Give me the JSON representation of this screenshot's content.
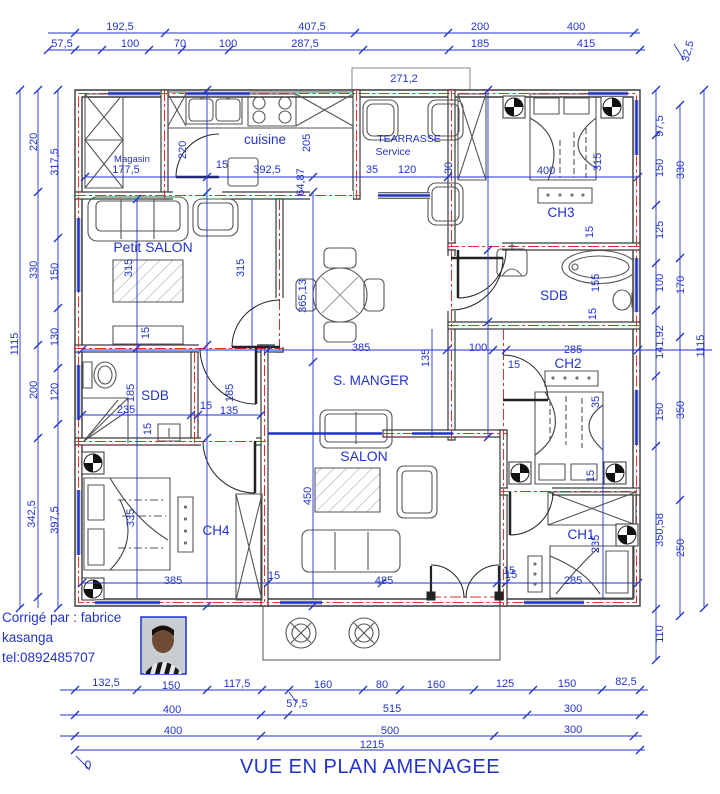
{
  "title": "VUE EN PLAN AMENAGEE",
  "credit": {
    "line1": "Corrigé par : fabrice",
    "line2": "kasanga",
    "line3": "tel:0892485707"
  },
  "colors": {
    "dimension_blue": "#2233cc",
    "wall_dark": "#3a3a3a",
    "axis_red": "#e03028",
    "background": "#ffffff"
  },
  "labels": [
    {
      "t": "192,5",
      "x": 120,
      "y": 30
    },
    {
      "t": "407,5",
      "x": 312,
      "y": 30
    },
    {
      "t": "200",
      "x": 480,
      "y": 30
    },
    {
      "t": "400",
      "x": 576,
      "y": 30
    },
    {
      "t": "57,5",
      "x": 62,
      "y": 47
    },
    {
      "t": "100",
      "x": 130,
      "y": 47
    },
    {
      "t": "70",
      "x": 180,
      "y": 47
    },
    {
      "t": "100",
      "x": 228,
      "y": 47
    },
    {
      "t": "287,5",
      "x": 305,
      "y": 47
    },
    {
      "t": "185",
      "x": 480,
      "y": 47
    },
    {
      "t": "415",
      "x": 586,
      "y": 47
    },
    {
      "t": "271,2",
      "x": 404,
      "y": 82
    },
    {
      "t": "32,5",
      "x": 691,
      "y": 52,
      "r": -75
    },
    {
      "t": "1115",
      "x": 18,
      "y": 344,
      "r": -90
    },
    {
      "t": "220",
      "x": 37,
      "y": 142,
      "r": -90
    },
    {
      "t": "317,5",
      "x": 58,
      "y": 162,
      "r": -90
    },
    {
      "t": "330",
      "x": 37,
      "y": 270,
      "r": -90
    },
    {
      "t": "150",
      "x": 58,
      "y": 272,
      "r": -90
    },
    {
      "t": "130",
      "x": 58,
      "y": 337,
      "r": -90
    },
    {
      "t": "200",
      "x": 37,
      "y": 390,
      "r": -90
    },
    {
      "t": "120",
      "x": 58,
      "y": 392,
      "r": -90
    },
    {
      "t": "342,5",
      "x": 35,
      "y": 514,
      "r": -90
    },
    {
      "t": "397,5",
      "x": 58,
      "y": 520,
      "r": -90
    },
    {
      "t": "97,5",
      "x": 663,
      "y": 126,
      "r": -90
    },
    {
      "t": "150",
      "x": 663,
      "y": 168,
      "r": -90
    },
    {
      "t": "330",
      "x": 684,
      "y": 170,
      "r": -90
    },
    {
      "t": "125",
      "x": 663,
      "y": 230,
      "r": -90
    },
    {
      "t": "100",
      "x": 663,
      "y": 283,
      "r": -90
    },
    {
      "t": "170",
      "x": 684,
      "y": 285,
      "r": -90
    },
    {
      "t": "141,92",
      "x": 663,
      "y": 342,
      "r": -90
    },
    {
      "t": "1115",
      "x": 704,
      "y": 346,
      "r": -90
    },
    {
      "t": "150",
      "x": 663,
      "y": 412,
      "r": -90
    },
    {
      "t": "350",
      "x": 684,
      "y": 410,
      "r": -90
    },
    {
      "t": "350,58",
      "x": 663,
      "y": 530,
      "r": -90
    },
    {
      "t": "250",
      "x": 684,
      "y": 548,
      "r": -90
    },
    {
      "t": "110",
      "x": 663,
      "y": 634,
      "r": -90
    },
    {
      "t": "132,5",
      "x": 106,
      "y": 686
    },
    {
      "t": "150",
      "x": 171,
      "y": 689
    },
    {
      "t": "117,5",
      "x": 237,
      "y": 687
    },
    {
      "t": "57,5",
      "x": 297,
      "y": 707
    },
    {
      "t": "160",
      "x": 323,
      "y": 688
    },
    {
      "t": "80",
      "x": 382,
      "y": 688
    },
    {
      "t": "160",
      "x": 436,
      "y": 688
    },
    {
      "t": "125",
      "x": 505,
      "y": 687
    },
    {
      "t": "150",
      "x": 567,
      "y": 687
    },
    {
      "t": "82,5",
      "x": 626,
      "y": 685
    },
    {
      "t": "400",
      "x": 172,
      "y": 713
    },
    {
      "t": "515",
      "x": 392,
      "y": 712
    },
    {
      "t": "300",
      "x": 573,
      "y": 712
    },
    {
      "t": "400",
      "x": 173,
      "y": 734
    },
    {
      "t": "500",
      "x": 390,
      "y": 734
    },
    {
      "t": "300",
      "x": 573,
      "y": 733
    },
    {
      "t": "1215",
      "x": 372,
      "y": 748
    },
    {
      "t": "0",
      "x": 88,
      "y": 769,
      "s": 12
    },
    {
      "t": "Magasin",
      "x": 132,
      "y": 162,
      "s": 9.5,
      "n": "room-label-magasin"
    },
    {
      "t": "177,5",
      "x": 126,
      "y": 173
    },
    {
      "t": "220",
      "x": 186,
      "y": 150,
      "r": -90
    },
    {
      "t": "15",
      "x": 222,
      "y": 168
    },
    {
      "t": "cuisine",
      "x": 265,
      "y": 144,
      "s": 13.5,
      "n": "room-label-cuisine"
    },
    {
      "t": "392,5",
      "x": 267,
      "y": 173
    },
    {
      "t": "205",
      "x": 310,
      "y": 143,
      "r": -90
    },
    {
      "t": "64,87",
      "x": 304,
      "y": 182,
      "r": -90
    },
    {
      "t": "TEARRASSE",
      "x": 409,
      "y": 142,
      "s": 10.5,
      "n": "room-label-terrasse"
    },
    {
      "t": "Service",
      "x": 393,
      "y": 155,
      "s": 10.5,
      "n": "room-label-terrasse-2"
    },
    {
      "t": "35",
      "x": 372,
      "y": 173
    },
    {
      "t": "120",
      "x": 407,
      "y": 173
    },
    {
      "t": "30",
      "x": 452,
      "y": 168,
      "r": -90
    },
    {
      "t": "400",
      "x": 546,
      "y": 174
    },
    {
      "t": "315",
      "x": 601,
      "y": 162,
      "r": -90
    },
    {
      "t": "CH3",
      "x": 561,
      "y": 217,
      "s": 13.5,
      "n": "room-label-ch3"
    },
    {
      "t": "15",
      "x": 593,
      "y": 232,
      "r": -90
    },
    {
      "t": "Petit SALON",
      "x": 153,
      "y": 252,
      "s": 14,
      "n": "room-label-petit-salon"
    },
    {
      "t": "315",
      "x": 132,
      "y": 268,
      "r": -90
    },
    {
      "t": "315",
      "x": 244,
      "y": 268,
      "r": -90
    },
    {
      "t": "365,13",
      "x": 306,
      "y": 296,
      "r": -90
    },
    {
      "t": "15",
      "x": 149,
      "y": 333,
      "r": -90
    },
    {
      "t": "SDB",
      "x": 155,
      "y": 400,
      "s": 13.5,
      "n": "room-label-sdb-left"
    },
    {
      "t": "185",
      "x": 134,
      "y": 393,
      "r": -90
    },
    {
      "t": "235",
      "x": 126,
      "y": 413
    },
    {
      "t": "15",
      "x": 151,
      "y": 429,
      "r": -90
    },
    {
      "t": "15",
      "x": 206,
      "y": 409
    },
    {
      "t": "135",
      "x": 229,
      "y": 414
    },
    {
      "t": "185",
      "x": 233,
      "y": 393,
      "r": -90
    },
    {
      "t": "S. MANGER",
      "x": 371,
      "y": 385,
      "s": 13.5,
      "n": "room-label-s-manger"
    },
    {
      "t": "385",
      "x": 361,
      "y": 351
    },
    {
      "t": "135",
      "x": 429,
      "y": 358,
      "r": -90
    },
    {
      "t": "100",
      "x": 478,
      "y": 351
    },
    {
      "t": "SDB",
      "x": 554,
      "y": 300,
      "s": 13.5,
      "n": "room-label-sdb-right"
    },
    {
      "t": "155",
      "x": 599,
      "y": 283,
      "r": -90
    },
    {
      "t": "15",
      "x": 596,
      "y": 314,
      "r": -90
    },
    {
      "t": "285",
      "x": 573,
      "y": 353
    },
    {
      "t": "CH2",
      "x": 568,
      "y": 368,
      "s": 13.5,
      "n": "room-label-ch2"
    },
    {
      "t": "15",
      "x": 514,
      "y": 368
    },
    {
      "t": "35",
      "x": 599,
      "y": 402,
      "r": -90
    },
    {
      "t": "SALON",
      "x": 364,
      "y": 461,
      "s": 14,
      "n": "room-label-salon"
    },
    {
      "t": "450",
      "x": 311,
      "y": 496,
      "r": -90
    },
    {
      "t": "485",
      "x": 384,
      "y": 584
    },
    {
      "t": "15",
      "x": 274,
      "y": 579
    },
    {
      "t": "15",
      "x": 509,
      "y": 574
    },
    {
      "t": "CH4",
      "x": 216,
      "y": 535,
      "s": 13.5,
      "n": "room-label-ch4"
    },
    {
      "t": "335",
      "x": 134,
      "y": 518,
      "r": -90
    },
    {
      "t": "385",
      "x": 173,
      "y": 584
    },
    {
      "t": "CH1",
      "x": 581,
      "y": 539,
      "s": 13.5,
      "n": "room-label-ch1"
    },
    {
      "t": "235",
      "x": 599,
      "y": 544,
      "r": -90
    },
    {
      "t": "15",
      "x": 594,
      "y": 476,
      "r": -90
    },
    {
      "t": "285",
      "x": 573,
      "y": 584
    },
    {
      "t": "15",
      "x": 511,
      "y": 578
    }
  ]
}
